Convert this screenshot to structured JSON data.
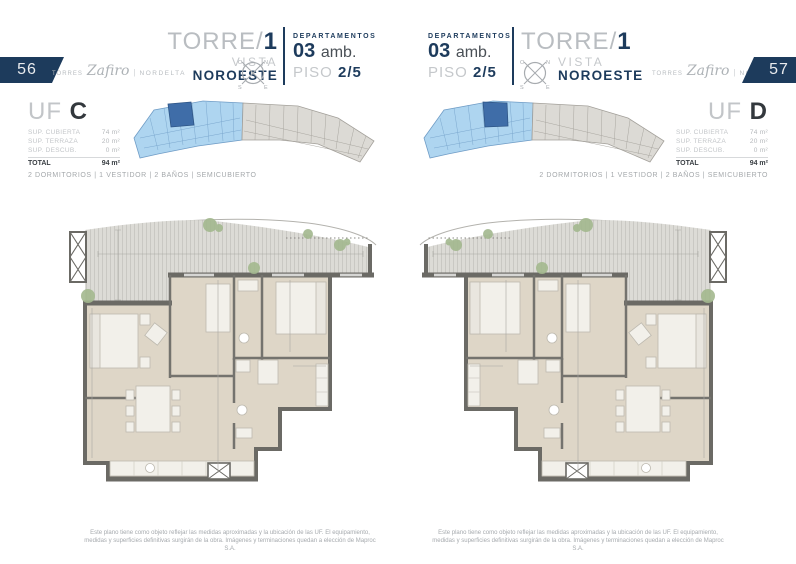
{
  "colors": {
    "navy": "#1d3b5c",
    "light_gray_text": "#c2c5c8",
    "keyplan_blue": "#aed5f0",
    "keyplan_highlight": "#3f6da8",
    "keyplan_gray": "#dcdad5",
    "floor_beige": "#ded6c7",
    "wall_gray": "#6b6a65"
  },
  "compass": {
    "nw": "O",
    "ne": "N",
    "sw": "S",
    "se": "E"
  },
  "left": {
    "page_number": "56",
    "brand": {
      "prefix": "Torres",
      "name": "Zafiro",
      "divider": "|",
      "suffix": "NORDELTA"
    },
    "tower": {
      "title": "TORRE/",
      "number": "1",
      "vista": "VISTA",
      "direction": "NOROESTE"
    },
    "dept": {
      "label": "DEPARTAMENTOS",
      "units": "03",
      "units_suffix": "amb.",
      "floor_label": "PISO",
      "floor_value": "2/5"
    },
    "unit": {
      "uf": "UF",
      "letter": "C",
      "surfaces": [
        {
          "label": "SUP. CUBIERTA",
          "value": "74 m²"
        },
        {
          "label": "SUP. TERRAZA",
          "value": "20 m²"
        },
        {
          "label": "SUP. DESCUB.",
          "value": "0 m²"
        }
      ],
      "total_label": "TOTAL",
      "total_value": "94 m²"
    },
    "features": "2 DORMITORIOS | 1 VESTIDOR | 2 BAÑOS | SEMICUBIERTO",
    "disclaimer": "Este plano tiene como objeto reflejar las medidas aproximadas y la ubicación de las UF. El equipamiento, medidas y superficies definitivas surgirán de la obra. Imágenes y terminaciones quedan a elección de Maproc S.A."
  },
  "right": {
    "page_number": "57",
    "brand": {
      "prefix": "Torres",
      "name": "Zafiro",
      "divider": "|",
      "suffix": "NORDELTA"
    },
    "tower": {
      "title": "TORRE/",
      "number": "1",
      "vista": "VISTA",
      "direction": "NOROESTE"
    },
    "dept": {
      "label": "DEPARTAMENTOS",
      "units": "03",
      "units_suffix": "amb.",
      "floor_label": "PISO",
      "floor_value": "2/5"
    },
    "unit": {
      "uf": "UF",
      "letter": "D",
      "surfaces": [
        {
          "label": "SUP. CUBIERTA",
          "value": "74 m²"
        },
        {
          "label": "SUP. TERRAZA",
          "value": "20 m²"
        },
        {
          "label": "SUP. DESCUB.",
          "value": "0 m²"
        }
      ],
      "total_label": "TOTAL",
      "total_value": "94 m²"
    },
    "features": "2 DORMITORIOS | 1 VESTIDOR | 2 BAÑOS | SEMICUBIERTO",
    "disclaimer": "Este plano tiene como objeto reflejar las medidas aproximadas y la ubicación de las UF. El equipamiento, medidas y superficies definitivas surgirán de la obra. Imágenes y terminaciones quedan a elección de Maproc S.A."
  }
}
